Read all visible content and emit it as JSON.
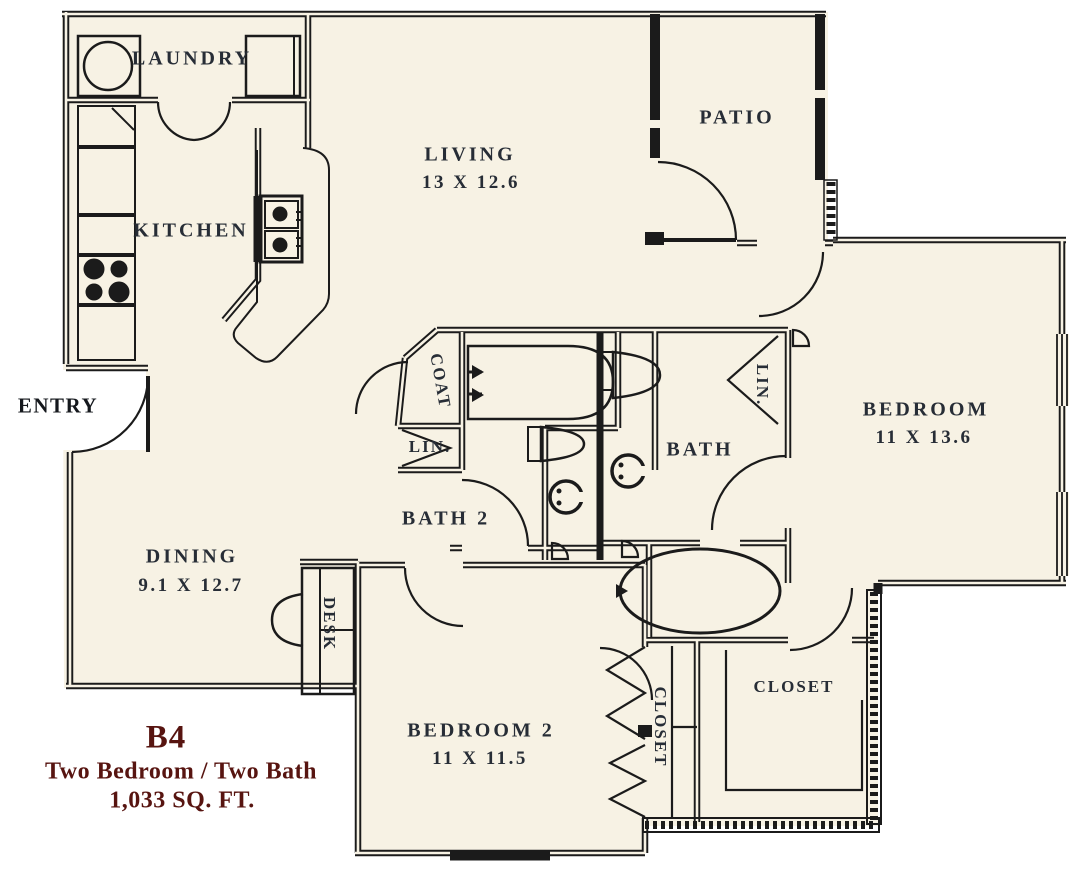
{
  "title": {
    "plan_code": "B4",
    "plan_type": "Two Bedroom / Two Bath",
    "plan_area": "1,033 SQ. FT."
  },
  "rooms": {
    "laundry": {
      "name": "LAUNDRY"
    },
    "kitchen": {
      "name": "KITCHEN"
    },
    "living": {
      "name": "LIVING",
      "dims": "13 X 12.6"
    },
    "patio": {
      "name": "PATIO"
    },
    "entry": {
      "name": "ENTRY"
    },
    "coat": {
      "name": "COAT"
    },
    "linen_hall": {
      "name": "LIN."
    },
    "bath2": {
      "name": "BATH 2"
    },
    "bath": {
      "name": "BATH"
    },
    "linen_bedroom": {
      "name": "LIN."
    },
    "bedroom": {
      "name": "BEDROOM",
      "dims": "11 X 13.6"
    },
    "dining": {
      "name": "DINING",
      "dims": "9.1 X 12.7"
    },
    "desk": {
      "name": "DESK"
    },
    "bedroom2": {
      "name": "BEDROOM 2",
      "dims": "11 X 11.5"
    },
    "closet_bedroom2": {
      "name": "CLOSET"
    },
    "closet_walkin": {
      "name": "CLOSET"
    }
  },
  "colors": {
    "wall": "#1b1b1b",
    "floor": "#f7f2e4",
    "label": "#272d36",
    "accent": "#571410",
    "background": "#ffffff"
  }
}
